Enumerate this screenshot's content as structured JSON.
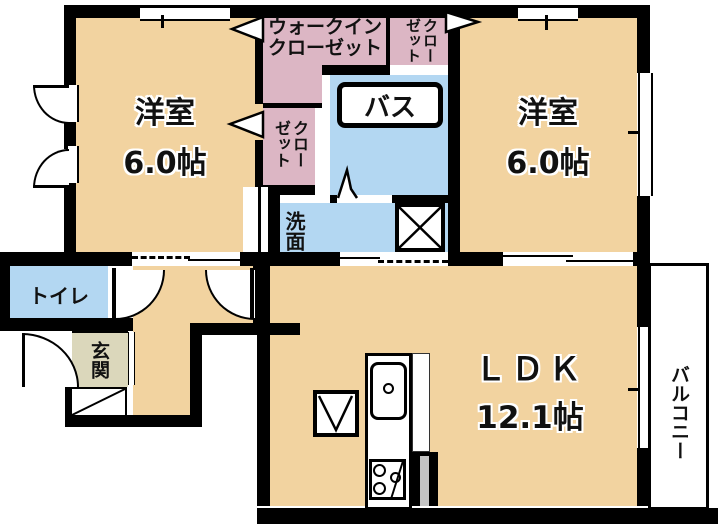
{
  "floorplan": {
    "title": "2LDK apartment floor plan",
    "rooms": {
      "bedroom1": {
        "name": "洋室",
        "size": "6.0帖"
      },
      "bedroom2": {
        "name": "洋室",
        "size": "6.0帖"
      },
      "ldk": {
        "name": "ＬＤＫ",
        "size": "12.1帖"
      },
      "walk_in_closet": {
        "name": "ウォークインクローゼット"
      },
      "closet_bedroom1": {
        "name": "クローゼット"
      },
      "closet_bedroom2": {
        "name": "クローゼット"
      },
      "bath": {
        "name": "バス"
      },
      "washroom": {
        "name": "洗面"
      },
      "toilet": {
        "name": "トイレ"
      },
      "entrance": {
        "name": "玄関"
      },
      "balcony": {
        "name": "バルコニー"
      }
    },
    "fixtures": [
      "kitchen-sink",
      "gas-stove",
      "washing-machine-pan",
      "refrigerator-space",
      "shoe-cabinet",
      "entrance-door",
      "toilet-door",
      "ldk-door",
      "sliding-doors",
      "windows",
      "folding-bath-door"
    ],
    "colors": {
      "room_floor": "#F2D3A0",
      "closet": "#DCB6C4",
      "wet_area": "#B3D7F2",
      "entrance_floor": "#DBD7BB",
      "wall": "#000000",
      "background": "#FFFFFF"
    }
  }
}
